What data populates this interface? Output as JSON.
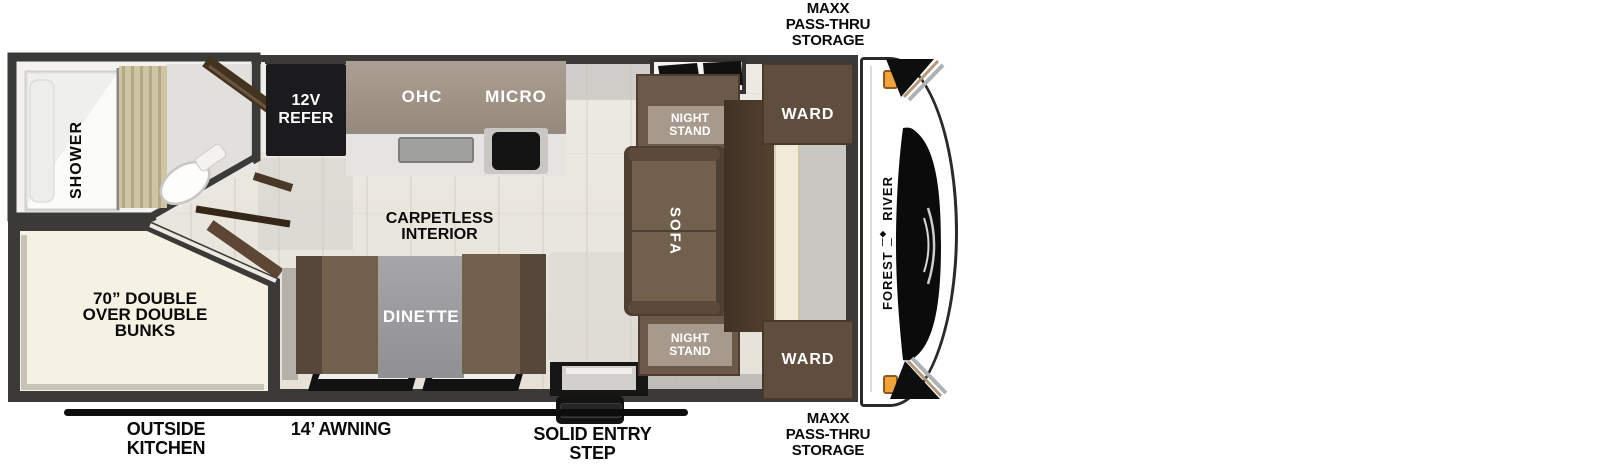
{
  "exterior_labels": {
    "storage_top": [
      "MAXX",
      "PASS-THRU",
      "STORAGE"
    ],
    "storage_bottom": [
      "MAXX",
      "PASS-THRU",
      "STORAGE"
    ],
    "outside_kitchen": [
      "OUTSIDE",
      "KITCHEN"
    ],
    "awning": "14’ AWNING",
    "entry_step": [
      "SOLID ENTRY",
      "STEP"
    ]
  },
  "interior_labels": {
    "carpetless": [
      "CARPETLESS",
      "INTERIOR"
    ],
    "bunks": [
      "70” DOUBLE",
      "OVER DOUBLE",
      "BUNKS"
    ],
    "shower": "SHOWER",
    "refer": [
      "12V",
      "REFER"
    ],
    "ohc": "OHC",
    "micro": "MICRO",
    "night_stand_top": [
      "NIGHT",
      "STAND"
    ],
    "night_stand_bottom": [
      "NIGHT",
      "STAND"
    ],
    "sofa": "SOFA",
    "ward_top": "WARD",
    "ward_bottom": "WARD",
    "dinette": "DINETTE"
  },
  "brand": {
    "name_first": "FOREST",
    "name_second": "RIVER"
  },
  "colors": {
    "wall": "#3b3a38",
    "floor": "#e8e4dc",
    "bunk_floor": "#f6f2e3",
    "cabinet_dark": "#5f4e3e",
    "cabinet_mid": "#72604e",
    "label_plate": "#a79a8d",
    "table_gray": "#9d9da0",
    "refer_black": "#1b1b1d",
    "marker_light_orange": "#f0a33a",
    "trim_tan": "#b3987b"
  }
}
